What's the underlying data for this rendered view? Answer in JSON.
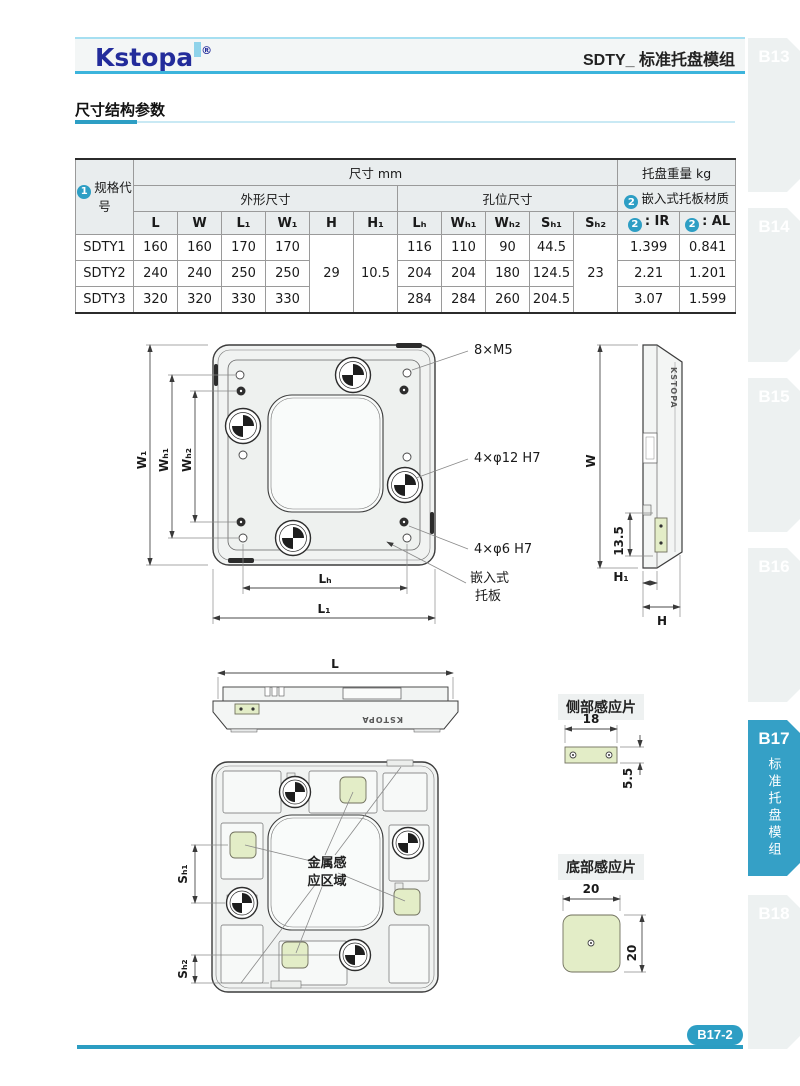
{
  "header": {
    "logo_text": "Kstopa",
    "logo_reg": "®",
    "title": "SDTY_ 标准托盘模组"
  },
  "section_title": "尺寸结构参数",
  "table": {
    "group_dim": "尺寸 mm",
    "group_weight": "托盘重量 kg",
    "spec_badge": "1",
    "spec_label": "规格代号",
    "sub_outer": "外形尺寸",
    "sub_hole": "孔位尺寸",
    "mat_badge": "2",
    "mat_label": "嵌入式托板材质",
    "dim_cols": [
      "L",
      "W",
      "L₁",
      "W₁",
      "H",
      "H₁",
      "Lₕ",
      "Wₕ₁",
      "Wₕ₂",
      "Sₕ₁",
      "Sₕ₂"
    ],
    "ir_badge": "2",
    "ir_label": ": IR",
    "al_badge": "2",
    "al_label": ": AL",
    "merged": {
      "H": "29",
      "H1": "10.5",
      "Sh2": "23"
    },
    "rows": [
      {
        "code": "SDTY1",
        "L": "160",
        "W": "160",
        "L1": "170",
        "W1": "170",
        "Lh": "116",
        "Wh1": "110",
        "Wh2": "90",
        "Sh1": "44.5",
        "ir": "1.399",
        "al": "0.841"
      },
      {
        "code": "SDTY2",
        "L": "240",
        "W": "240",
        "L1": "250",
        "W1": "250",
        "Lh": "204",
        "Wh1": "204",
        "Wh2": "180",
        "Sh1": "124.5",
        "ir": "2.21",
        "al": "1.201"
      },
      {
        "code": "SDTY3",
        "L": "320",
        "W": "320",
        "L1": "330",
        "W1": "330",
        "Lh": "284",
        "Wh1": "284",
        "Wh2": "260",
        "Sh1": "204.5",
        "ir": "3.07",
        "al": "1.599"
      }
    ]
  },
  "drawings": {
    "top": {
      "m5": "8×M5",
      "d12": "4×φ12 H7",
      "d6": "4×φ6 H7",
      "tray1": "嵌入式",
      "tray2": "托板",
      "w1": "W₁",
      "wh1": "Wₕ₁",
      "wh2": "Wₕ₂",
      "lh": "Lₕ",
      "l1": "L₁"
    },
    "side": {
      "w": "W",
      "v135": "13.5",
      "h1": "H₁",
      "h": "H",
      "brand": "KSTOPA"
    },
    "front": {
      "l": "L",
      "brand": "KSTOPA"
    },
    "bottom": {
      "zone1": "金属感",
      "zone2": "应区域",
      "sh1": "Sₕ₁",
      "sh2": "Sₕ₂"
    },
    "side_sensor": {
      "title": "侧部感应片",
      "w": "18",
      "h": "5.5"
    },
    "bottom_sensor": {
      "title": "底部感应片",
      "w": "20",
      "h": "20"
    }
  },
  "tabs": [
    {
      "label": "B13"
    },
    {
      "label": "B14"
    },
    {
      "label": "B15"
    },
    {
      "label": "B16"
    },
    {
      "label": "B17",
      "sub": "标准托盘模组"
    },
    {
      "label": "B18"
    }
  ],
  "footer": {
    "page": "B17-2"
  }
}
